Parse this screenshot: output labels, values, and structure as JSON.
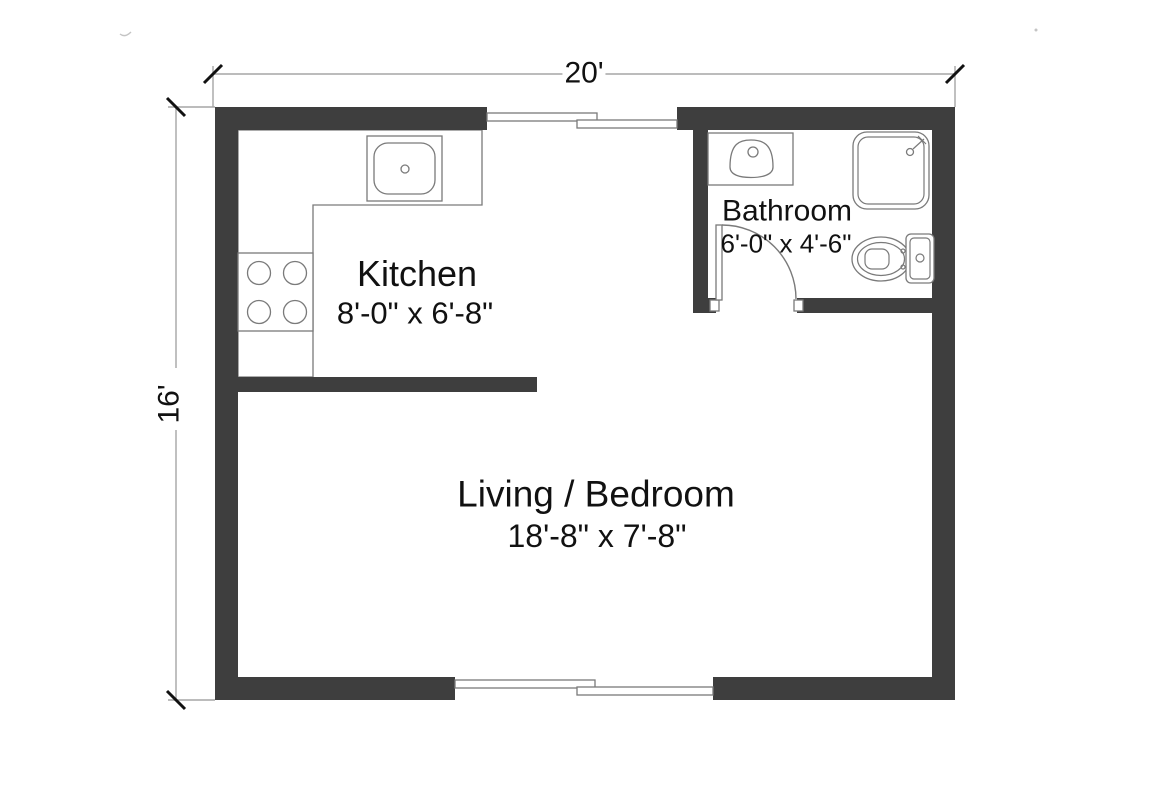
{
  "title": "Floor plan — 20' x 16' studio unit",
  "colors": {
    "wall": "#3e3e3e",
    "outline": "#7a7a7a",
    "dimline": "#a6a6a6",
    "text": "#111111",
    "background": "#ffffff"
  },
  "overall_dimensions": {
    "width_label": "20'",
    "height_label": "16'"
  },
  "rooms": [
    {
      "id": "kitchen",
      "name": "Kitchen",
      "dims": "8'-0\" x 6'-8\""
    },
    {
      "id": "bathroom",
      "name": "Bathroom",
      "dims": "6'-0\" x 4'-6\""
    },
    {
      "id": "living_bedroom",
      "name": "Living / Bedroom",
      "dims": "18'-8\" x 7'-8\""
    }
  ],
  "fixtures": [
    {
      "id": "kitchen-sink",
      "icon": "sink-top-view-icon",
      "room": "kitchen"
    },
    {
      "id": "stove",
      "icon": "four-burner-stove-icon",
      "room": "kitchen"
    },
    {
      "id": "counter",
      "icon": "l-shaped-counter-outline",
      "room": "kitchen"
    },
    {
      "id": "bathroom-sink",
      "icon": "basin-top-view-icon",
      "room": "bathroom"
    },
    {
      "id": "shower",
      "icon": "shower-stall-icon",
      "room": "bathroom"
    },
    {
      "id": "toilet",
      "icon": "toilet-top-view-icon",
      "room": "bathroom"
    },
    {
      "id": "bathroom-door",
      "icon": "door-swing-arc",
      "room": "bathroom"
    }
  ],
  "openings": [
    {
      "id": "top-window",
      "type": "sliding-window",
      "wall": "north"
    },
    {
      "id": "bottom-sliding-door",
      "type": "sliding-door",
      "wall": "south"
    }
  ]
}
